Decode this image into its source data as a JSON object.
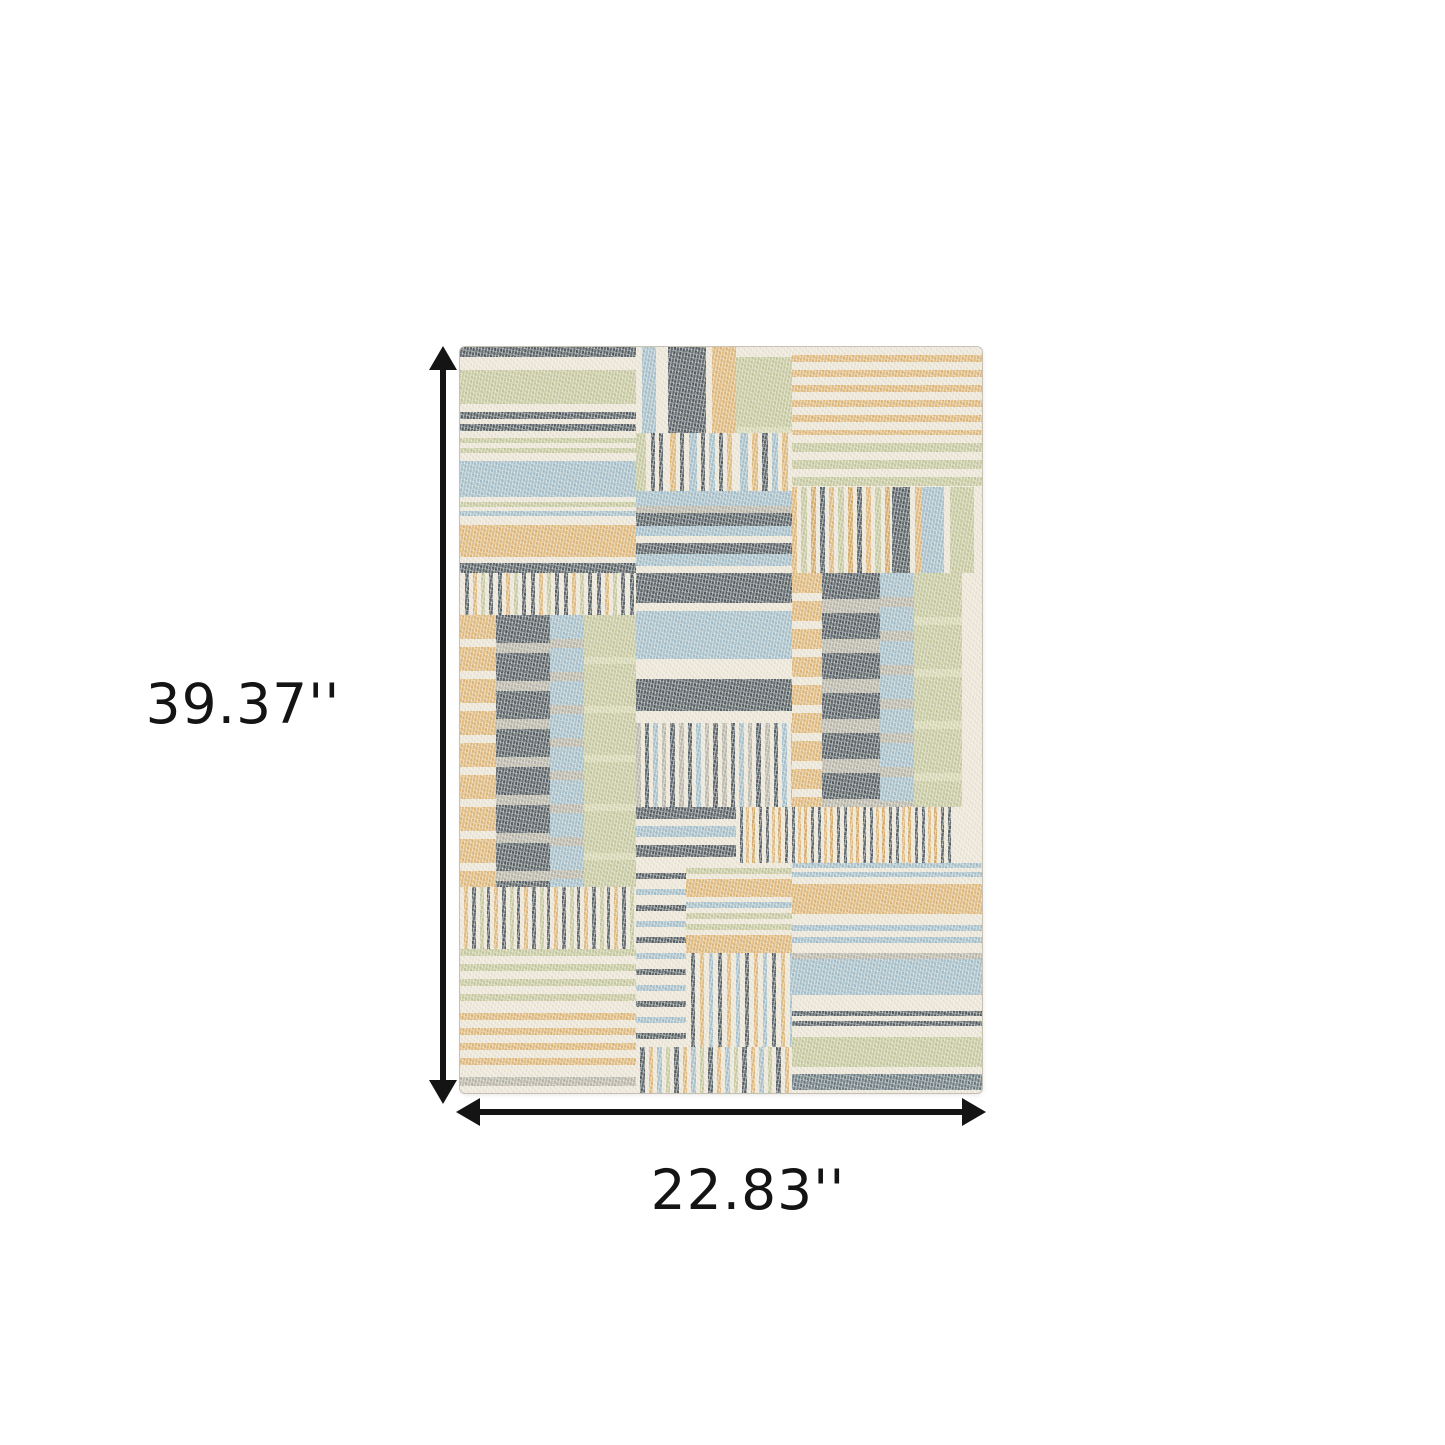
{
  "image": {
    "width": 1445,
    "height": 1445,
    "background": "#ffffff"
  },
  "dimensions": {
    "height_label": "39.37''",
    "width_label": "22.83''",
    "arrow_color": "#141414",
    "label_color": "#141414"
  },
  "rug": {
    "left": 460,
    "top": 347,
    "width": 522,
    "height": 746,
    "base_color": "#ede7d9",
    "palette": {
      "cream": "#ede7d9",
      "cream2": "#f3efe4",
      "green": "#c4c79c",
      "greenlt": "#d4d6b0",
      "blue": "#a0bdcc",
      "gold": "#dfb575",
      "tan": "#d5a65f",
      "dark": "#4e5960",
      "darkblue": "#64757f",
      "gray": "#b6b4a8"
    },
    "patches": [
      {
        "x": 0,
        "y": 0,
        "w": 176,
        "h": 226,
        "dir": "h",
        "stripes": [
          [
            "dark",
            10
          ],
          [
            "cream",
            13
          ],
          [
            "green",
            34
          ],
          [
            "cream",
            8
          ],
          [
            "dark",
            7
          ],
          [
            "cream",
            5
          ],
          [
            "dark",
            7
          ],
          [
            "cream",
            7
          ],
          [
            "green",
            5
          ],
          [
            "cream",
            5
          ],
          [
            "green",
            5
          ],
          [
            "cream",
            8
          ],
          [
            "blue",
            36
          ],
          [
            "cream",
            5
          ],
          [
            "green",
            5
          ],
          [
            "cream",
            4
          ],
          [
            "blue",
            5
          ],
          [
            "cream",
            9
          ],
          [
            "gold",
            32
          ],
          [
            "cream",
            6
          ],
          [
            "dark",
            10
          ]
        ]
      },
      {
        "x": 176,
        "y": 0,
        "w": 100,
        "h": 86,
        "dir": "v",
        "stripes": [
          [
            "cream",
            6
          ],
          [
            "blue",
            14
          ],
          [
            "cream",
            12
          ],
          [
            "dark",
            38
          ],
          [
            "cream",
            6
          ],
          [
            "gold",
            24
          ]
        ]
      },
      {
        "x": 276,
        "y": 10,
        "w": 56,
        "h": 76,
        "dir": "h",
        "stripes": [
          [
            "green",
            70
          ],
          [
            "greenlt",
            6
          ]
        ]
      },
      {
        "x": 332,
        "y": 0,
        "w": 190,
        "h": 88,
        "dir": "h",
        "stripes": [
          [
            "cream",
            8
          ],
          [
            "gold",
            7
          ]
        ]
      },
      {
        "x": 176,
        "y": 86,
        "w": 100,
        "h": 58,
        "dir": "v",
        "stripes": [
          [
            "green",
            10
          ],
          [
            "cream",
            5
          ],
          [
            "dark",
            4
          ],
          [
            "cream",
            4
          ],
          [
            "dark",
            4
          ],
          [
            "cream",
            7
          ],
          [
            "gold",
            6
          ],
          [
            "cream",
            4
          ],
          [
            "dark",
            4
          ],
          [
            "cream",
            5
          ],
          [
            "blue",
            8
          ],
          [
            "cream",
            4
          ],
          [
            "dark",
            4
          ],
          [
            "cream",
            4
          ],
          [
            "blue",
            6
          ],
          [
            "cream",
            4
          ],
          [
            "dark",
            4
          ],
          [
            "cream",
            4
          ],
          [
            "gold",
            5
          ],
          [
            "cream",
            4
          ]
        ]
      },
      {
        "x": 276,
        "y": 86,
        "w": 56,
        "h": 58,
        "dir": "v",
        "stripes": [
          [
            "cream",
            4
          ],
          [
            "blue",
            8
          ],
          [
            "cream",
            4
          ],
          [
            "gold",
            6
          ],
          [
            "cream",
            4
          ],
          [
            "dark",
            6
          ],
          [
            "cream",
            4
          ],
          [
            "blue",
            6
          ],
          [
            "cream",
            4
          ],
          [
            "gold",
            6
          ],
          [
            "cream",
            4
          ]
        ]
      },
      {
        "x": 332,
        "y": 88,
        "w": 190,
        "h": 52,
        "dir": "h",
        "stripes": [
          [
            "cream",
            8
          ],
          [
            "green",
            9
          ]
        ]
      },
      {
        "x": 176,
        "y": 144,
        "w": 156,
        "h": 82,
        "dir": "h",
        "stripes": [
          [
            "blue",
            15
          ],
          [
            "gray",
            7
          ],
          [
            "dark",
            13
          ],
          [
            "blue",
            10
          ],
          [
            "cream",
            7
          ],
          [
            "dark",
            11
          ],
          [
            "blue",
            12
          ],
          [
            "cream",
            7
          ]
        ]
      },
      {
        "x": 332,
        "y": 140,
        "w": 100,
        "h": 86,
        "dir": "v",
        "stripes": [
          [
            "gold",
            5
          ],
          [
            "cream",
            4
          ],
          [
            "green",
            6
          ],
          [
            "cream",
            4
          ],
          [
            "tan",
            5
          ],
          [
            "cream",
            4
          ],
          [
            "dark",
            5
          ],
          [
            "cream",
            4
          ]
        ]
      },
      {
        "x": 432,
        "y": 140,
        "w": 30,
        "h": 86,
        "dir": "v",
        "stripes": [
          [
            "dark",
            18
          ],
          [
            "cream",
            5
          ],
          [
            "gold",
            7
          ]
        ]
      },
      {
        "x": 462,
        "y": 140,
        "w": 60,
        "h": 86,
        "dir": "v",
        "stripes": [
          [
            "blue",
            22
          ],
          [
            "cream",
            6
          ],
          [
            "green",
            24
          ],
          [
            "cream",
            8
          ]
        ]
      },
      {
        "x": 0,
        "y": 226,
        "w": 176,
        "h": 42,
        "dir": "v",
        "stripes": [
          [
            "cream",
            5
          ],
          [
            "dark",
            4
          ],
          [
            "cream",
            4
          ],
          [
            "gold",
            4
          ],
          [
            "cream",
            4
          ],
          [
            "green",
            4
          ],
          [
            "cream",
            4
          ],
          [
            "dark",
            4
          ]
        ]
      },
      {
        "x": 0,
        "y": 268,
        "w": 36,
        "h": 272,
        "dir": "h",
        "stripes": [
          [
            "gold",
            24
          ],
          [
            "cream",
            8
          ]
        ]
      },
      {
        "x": 36,
        "y": 268,
        "w": 54,
        "h": 272,
        "dir": "h",
        "stripes": [
          [
            "dark",
            28
          ],
          [
            "gray",
            10
          ]
        ]
      },
      {
        "x": 90,
        "y": 268,
        "w": 34,
        "h": 272,
        "dir": "h",
        "stripes": [
          [
            "blue",
            24
          ],
          [
            "gray",
            9
          ]
        ]
      },
      {
        "x": 124,
        "y": 268,
        "w": 52,
        "h": 272,
        "dir": "h",
        "stripes": [
          [
            "green",
            42
          ],
          [
            "greenlt",
            7
          ]
        ]
      },
      {
        "x": 176,
        "y": 226,
        "w": 156,
        "h": 150,
        "dir": "h",
        "stripes": [
          [
            "dark",
            30
          ],
          [
            "cream",
            8
          ],
          [
            "blue",
            48
          ],
          [
            "cream",
            20
          ],
          [
            "dark",
            32
          ],
          [
            "cream",
            12
          ]
        ]
      },
      {
        "x": 176,
        "y": 376,
        "w": 156,
        "h": 84,
        "dir": "v",
        "stripes": [
          [
            "gray",
            5
          ],
          [
            "cream",
            4
          ],
          [
            "dark",
            4
          ],
          [
            "cream",
            4
          ],
          [
            "blue",
            5
          ],
          [
            "cream",
            4
          ],
          [
            "gray",
            4
          ],
          [
            "cream",
            4
          ],
          [
            "dark",
            5
          ],
          [
            "cream",
            4
          ]
        ]
      },
      {
        "x": 332,
        "y": 226,
        "w": 30,
        "h": 234,
        "dir": "h",
        "stripes": [
          [
            "gold",
            20
          ],
          [
            "cream",
            8
          ]
        ]
      },
      {
        "x": 362,
        "y": 226,
        "w": 58,
        "h": 234,
        "dir": "h",
        "stripes": [
          [
            "dark",
            26
          ],
          [
            "gray",
            14
          ]
        ]
      },
      {
        "x": 420,
        "y": 226,
        "w": 34,
        "h": 234,
        "dir": "h",
        "stripes": [
          [
            "blue",
            24
          ],
          [
            "gray",
            10
          ]
        ]
      },
      {
        "x": 454,
        "y": 226,
        "w": 48,
        "h": 234,
        "dir": "h",
        "stripes": [
          [
            "green",
            44
          ],
          [
            "greenlt",
            8
          ]
        ]
      },
      {
        "x": 176,
        "y": 460,
        "w": 100,
        "h": 56,
        "dir": "h",
        "stripes": [
          [
            "dark",
            12
          ],
          [
            "cream",
            7
          ],
          [
            "blue",
            11
          ],
          [
            "cream",
            8
          ]
        ]
      },
      {
        "x": 276,
        "y": 460,
        "w": 216,
        "h": 56,
        "dir": "v",
        "stripes": [
          [
            "cream",
            4
          ],
          [
            "dark",
            3
          ],
          [
            "cream",
            3
          ],
          [
            "gold",
            3
          ],
          [
            "cream",
            3
          ],
          [
            "tan",
            3
          ],
          [
            "cream",
            4
          ],
          [
            "dark",
            3
          ]
        ]
      },
      {
        "x": 0,
        "y": 540,
        "w": 176,
        "h": 62,
        "dir": "v",
        "stripes": [
          [
            "cream",
            4
          ],
          [
            "gold",
            4
          ],
          [
            "cream",
            4
          ],
          [
            "dark",
            4
          ],
          [
            "cream",
            4
          ],
          [
            "green",
            4
          ],
          [
            "cream",
            3
          ],
          [
            "dark",
            3
          ]
        ]
      },
      {
        "x": 0,
        "y": 602,
        "w": 176,
        "h": 56,
        "dir": "h",
        "stripes": [
          [
            "green",
            7
          ],
          [
            "cream",
            8
          ]
        ]
      },
      {
        "x": 0,
        "y": 666,
        "w": 176,
        "h": 58,
        "dir": "h",
        "stripes": [
          [
            "gold",
            7
          ],
          [
            "cream",
            8
          ]
        ]
      },
      {
        "x": 0,
        "y": 724,
        "w": 176,
        "h": 22,
        "dir": "h",
        "stripes": [
          [
            "cream",
            6
          ],
          [
            "gray",
            9
          ],
          [
            "cream",
            7
          ]
        ]
      },
      {
        "x": 176,
        "y": 516,
        "w": 50,
        "h": 184,
        "dir": "h",
        "stripes": [
          [
            "cream",
            10
          ],
          [
            "dark",
            6
          ],
          [
            "cream",
            10
          ],
          [
            "blue",
            6
          ]
        ]
      },
      {
        "x": 226,
        "y": 516,
        "w": 106,
        "h": 90,
        "dir": "h",
        "stripes": [
          [
            "cream",
            5
          ],
          [
            "green",
            6
          ],
          [
            "cream",
            5
          ],
          [
            "gold",
            18
          ],
          [
            "cream",
            5
          ],
          [
            "blue",
            6
          ],
          [
            "cream",
            5
          ],
          [
            "green",
            6
          ]
        ]
      },
      {
        "x": 226,
        "y": 606,
        "w": 106,
        "h": 94,
        "dir": "v",
        "stripes": [
          [
            "cream",
            5
          ],
          [
            "dark",
            4
          ],
          [
            "cream",
            5
          ],
          [
            "gold",
            4
          ],
          [
            "cream",
            5
          ],
          [
            "blue",
            4
          ]
        ]
      },
      {
        "x": 176,
        "y": 700,
        "w": 156,
        "h": 46,
        "dir": "v",
        "stripes": [
          [
            "cream",
            4
          ],
          [
            "dark",
            5
          ],
          [
            "cream",
            4
          ],
          [
            "gold",
            4
          ],
          [
            "cream",
            4
          ],
          [
            "blue",
            5
          ],
          [
            "cream",
            4
          ],
          [
            "green",
            4
          ]
        ]
      },
      {
        "x": 332,
        "y": 516,
        "w": 190,
        "h": 16,
        "dir": "h",
        "stripes": [
          [
            "blue",
            5
          ],
          [
            "cream",
            4
          ]
        ]
      },
      {
        "x": 332,
        "y": 532,
        "w": 190,
        "h": 46,
        "dir": "h",
        "stripes": [
          [
            "cream",
            5
          ],
          [
            "gold",
            30
          ],
          [
            "cream",
            11
          ]
        ]
      },
      {
        "x": 332,
        "y": 578,
        "w": 190,
        "h": 34,
        "dir": "h",
        "stripes": [
          [
            "blue",
            6
          ],
          [
            "cream",
            6
          ],
          [
            "blue",
            6
          ],
          [
            "cream",
            10
          ],
          [
            "gray",
            6
          ]
        ]
      },
      {
        "x": 332,
        "y": 612,
        "w": 190,
        "h": 44,
        "dir": "h",
        "stripes": [
          [
            "blue",
            36
          ],
          [
            "cream",
            8
          ]
        ]
      },
      {
        "x": 332,
        "y": 656,
        "w": 190,
        "h": 34,
        "dir": "h",
        "stripes": [
          [
            "cream",
            8
          ],
          [
            "dark",
            5
          ],
          [
            "cream",
            5
          ],
          [
            "dark",
            5
          ],
          [
            "cream",
            11
          ]
        ]
      },
      {
        "x": 332,
        "y": 690,
        "w": 190,
        "h": 34,
        "dir": "h",
        "stripes": [
          [
            "green",
            30
          ],
          [
            "cream",
            4
          ]
        ]
      },
      {
        "x": 332,
        "y": 724,
        "w": 190,
        "h": 22,
        "dir": "h",
        "stripes": [
          [
            "cream",
            3
          ],
          [
            "darkblue",
            16
          ],
          [
            "cream",
            3
          ]
        ]
      }
    ]
  }
}
